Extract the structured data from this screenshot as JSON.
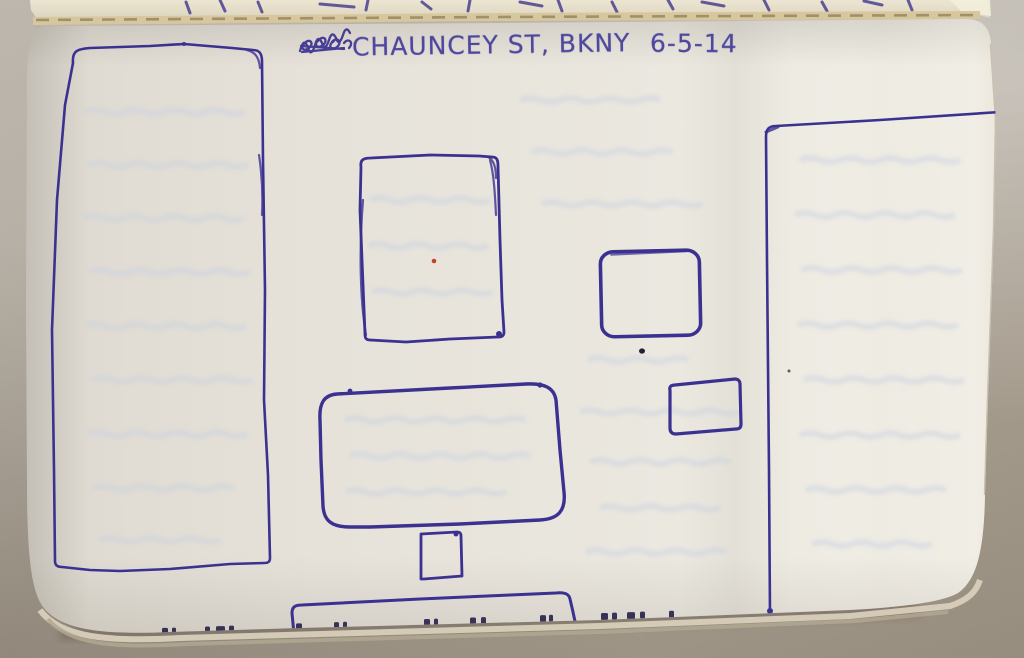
{
  "header": {
    "title": "CHAUNCEY ST, BKNY",
    "date": "6-5-14"
  },
  "sketch": {
    "ink_color": "#3b3190",
    "accent_dot_color": "#bf4428",
    "paper_color": "#e8e5dd",
    "shapes": [
      "left-tall-rectangle",
      "top-middle-rectangle",
      "center-rounded-rectangle",
      "small-square-below-center",
      "bottom-partial-rectangle",
      "right-large-open-rectangle",
      "small-rounded-square-right",
      "small-rectangle-right"
    ]
  }
}
